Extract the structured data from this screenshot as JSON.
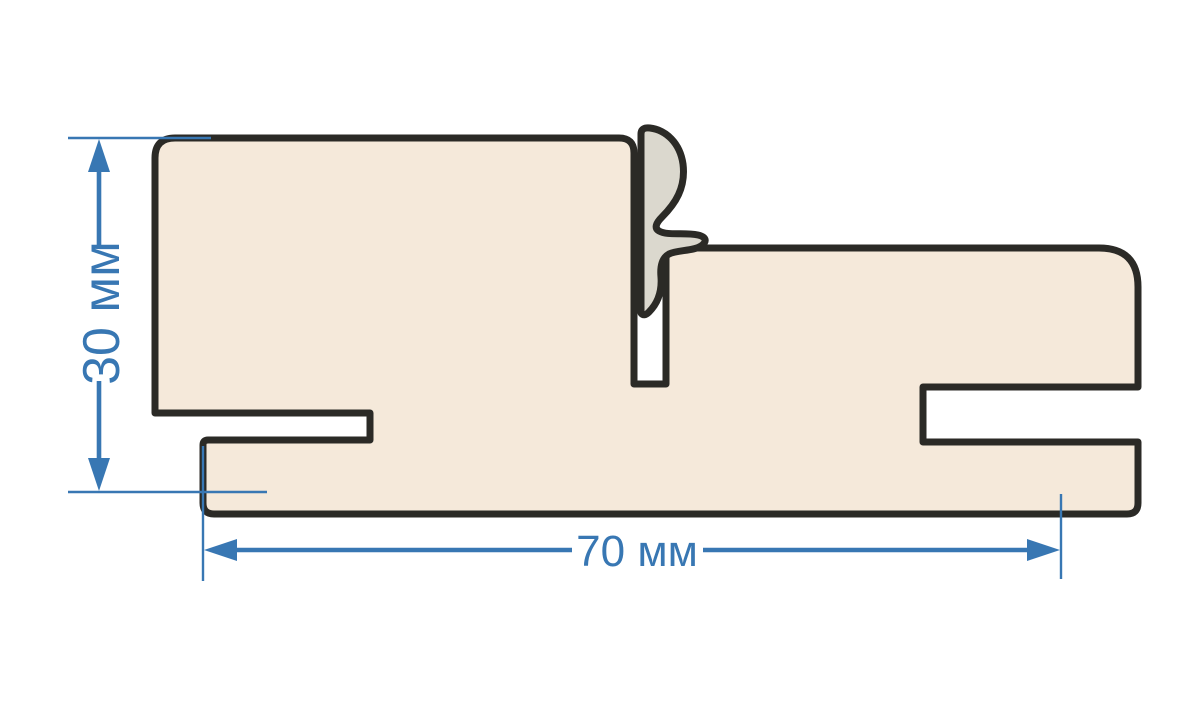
{
  "page": {
    "background": "#ffffff",
    "description": "Technical cross-section drawing of a door frame profile with seal"
  },
  "diagram": {
    "kind": "door-frame-profile-cross-section",
    "profile": {
      "part": "frame-profile-body",
      "fill": "#f5e9da",
      "outline": "#2b2a26"
    },
    "seal": {
      "part": "seal-gasket",
      "fill": "#dbd8ce",
      "outline": "#2b2a26"
    },
    "dimension_color": "#3877b3",
    "dimensions": [
      {
        "id": "height",
        "label": "30 мм",
        "value": 30,
        "unit": "мм",
        "orientation": "vertical"
      },
      {
        "id": "width",
        "label": "70 мм",
        "value": 70,
        "unit": "мм",
        "orientation": "horizontal"
      }
    ]
  }
}
